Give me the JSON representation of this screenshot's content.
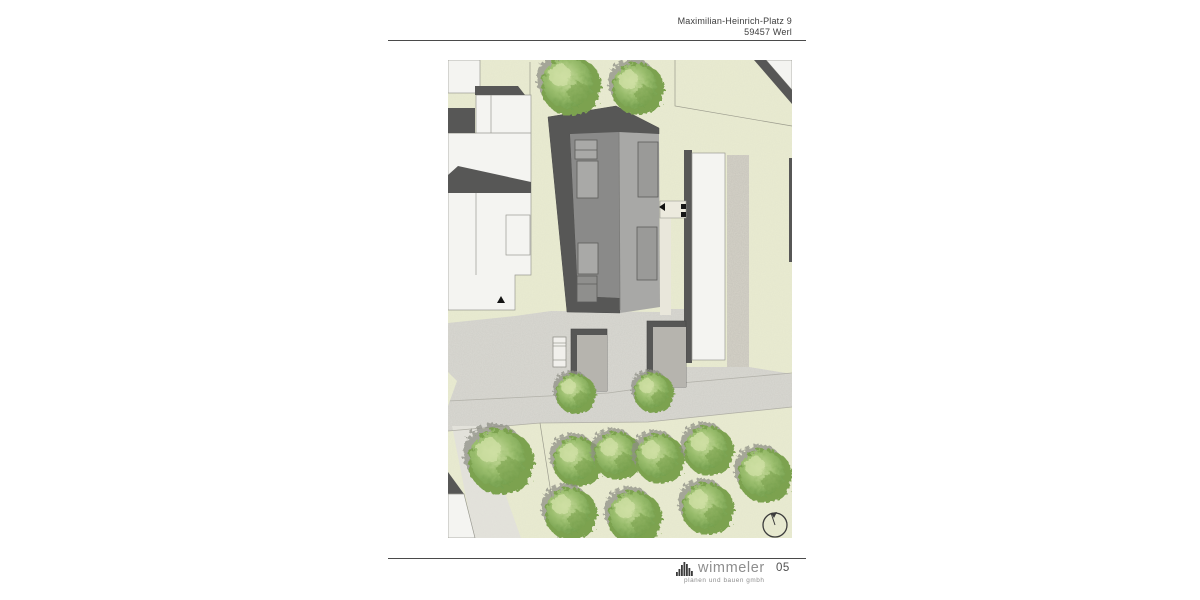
{
  "header": {
    "address_line1": "Maximilian-Heinrich-Platz 9",
    "address_line2": "59457 Werl"
  },
  "footer": {
    "brand": "wimmeler",
    "tagline": "planen und bauen gmbh"
  },
  "page": {
    "number": "05",
    "background": "#ffffff",
    "rule_color": "#4a4a4a"
  },
  "site_plan": {
    "type": "architectural-site-plan",
    "garages_count": 2,
    "trees_count": 13,
    "has_north_symbol": true,
    "colors": {
      "grass": "#e9ebd1",
      "pavement": "#dad9d3",
      "path": "#e4e3dc",
      "gravel": "#d6d3c9",
      "building_white": "#f4f4f1",
      "dark": "#575756",
      "roof_medium": "#8a8a89",
      "roof_light": "#a8a8a6",
      "ridge": "#7b7b79",
      "window_left": "#a9a9a7",
      "window_right": "#9a9a98",
      "window_shadow": "#8f8f8d",
      "garage": "#b6b4ae",
      "walkway": "#e9e7db",
      "landing": "#eceade",
      "outline": "#9a9a92",
      "parcel_line": "#9b9b8d",
      "tree_dark": "#6f9b49",
      "tree_mid": "#9cbf6f",
      "tree_light": "#cfe0a4",
      "tree_base": "#7ca24f",
      "tree_shadow": "#8f9086",
      "north_symbol": "#3c3c3c",
      "marker_black": "#141414"
    }
  }
}
